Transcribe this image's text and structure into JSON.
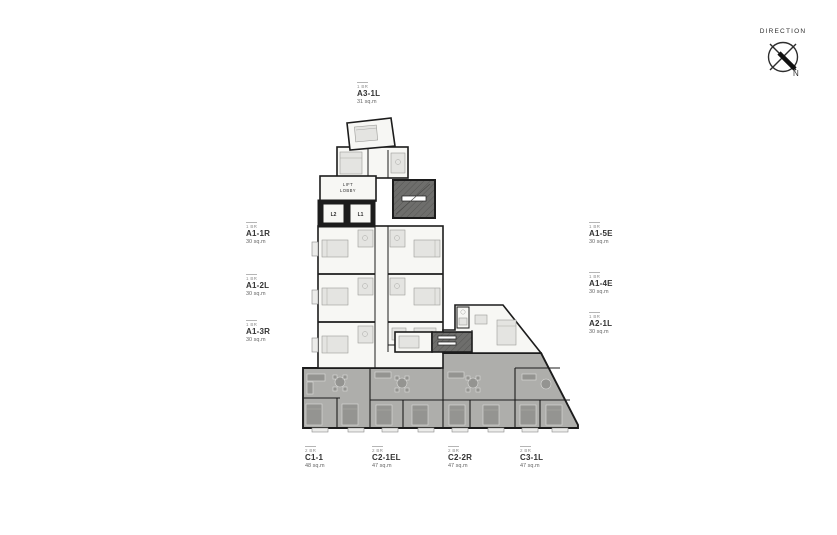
{
  "compass": {
    "label": "DIRECTION",
    "north_label": "N"
  },
  "plan": {
    "lift_lobby_line1": "LIFT",
    "lift_lobby_line2": "LOBBY",
    "lift_1": "L1",
    "lift_2": "L2"
  },
  "units": [
    {
      "id": "A3-1L",
      "type": "1 BR",
      "area": "31 sq.m"
    },
    {
      "id": "A1-1R",
      "type": "1 BR",
      "area": "30 sq.m"
    },
    {
      "id": "A1-2L",
      "type": "1 BR",
      "area": "30 sq.m"
    },
    {
      "id": "A1-3R",
      "type": "1 BR",
      "area": "30 sq.m"
    },
    {
      "id": "A1-5E",
      "type": "1 BR",
      "area": "30 sq.m"
    },
    {
      "id": "A1-4E",
      "type": "1 BR",
      "area": "30 sq.m"
    },
    {
      "id": "A2-1L",
      "type": "1 BR",
      "area": "30 sq.m"
    },
    {
      "id": "C1-1",
      "type": "2 BR",
      "area": "48 sq.m"
    },
    {
      "id": "C2-1EL",
      "type": "2 BR",
      "area": "47 sq.m"
    },
    {
      "id": "C2-2R",
      "type": "2 BR",
      "area": "47 sq.m"
    },
    {
      "id": "C3-1L",
      "type": "2 BR",
      "area": "47 sq.m"
    }
  ],
  "colors": {
    "wall": "#1c1c1c",
    "unit_floor": "#f7f7f4",
    "common_area": "#aeaeab",
    "core": "#6e6e6c",
    "label_text": "#333333"
  }
}
